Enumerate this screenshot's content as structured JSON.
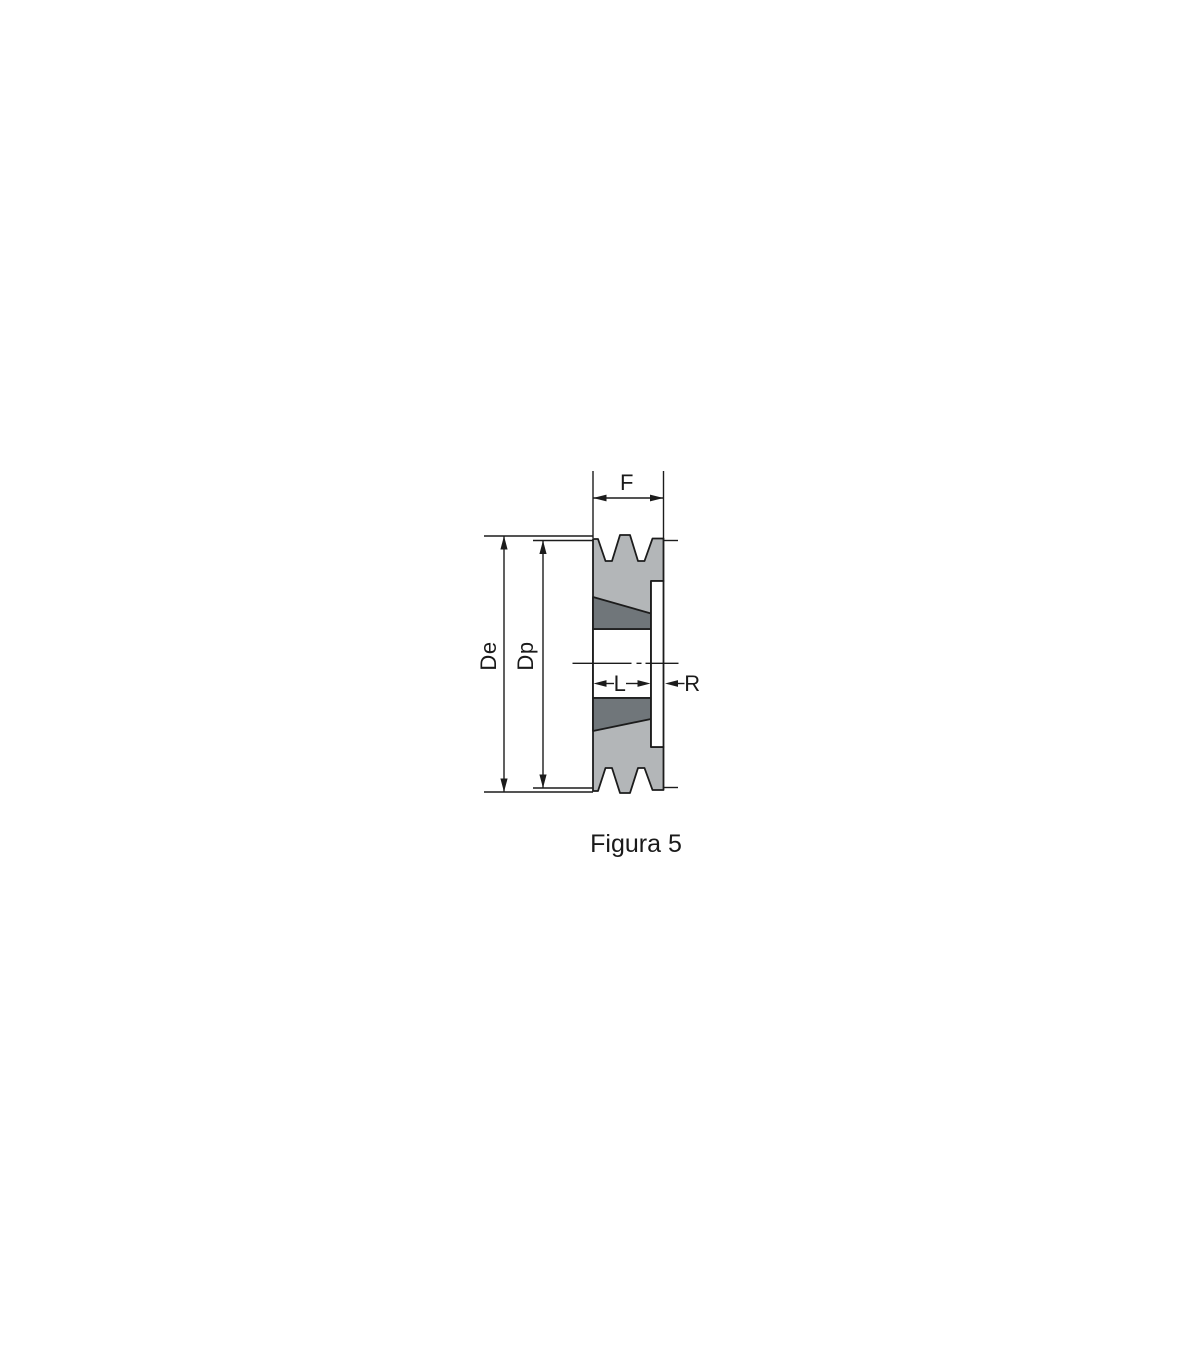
{
  "figure": {
    "caption": "Figura 5",
    "labels": {
      "face_width": "F",
      "outer_diameter": "De",
      "pitch_diameter": "Dp",
      "hub_length": "L",
      "recess_width": "R"
    },
    "colors": {
      "body_fill": "#b3b6b8",
      "bushing_fill": "#70767a",
      "line": "#1c1c1c",
      "background": "#ffffff"
    }
  }
}
